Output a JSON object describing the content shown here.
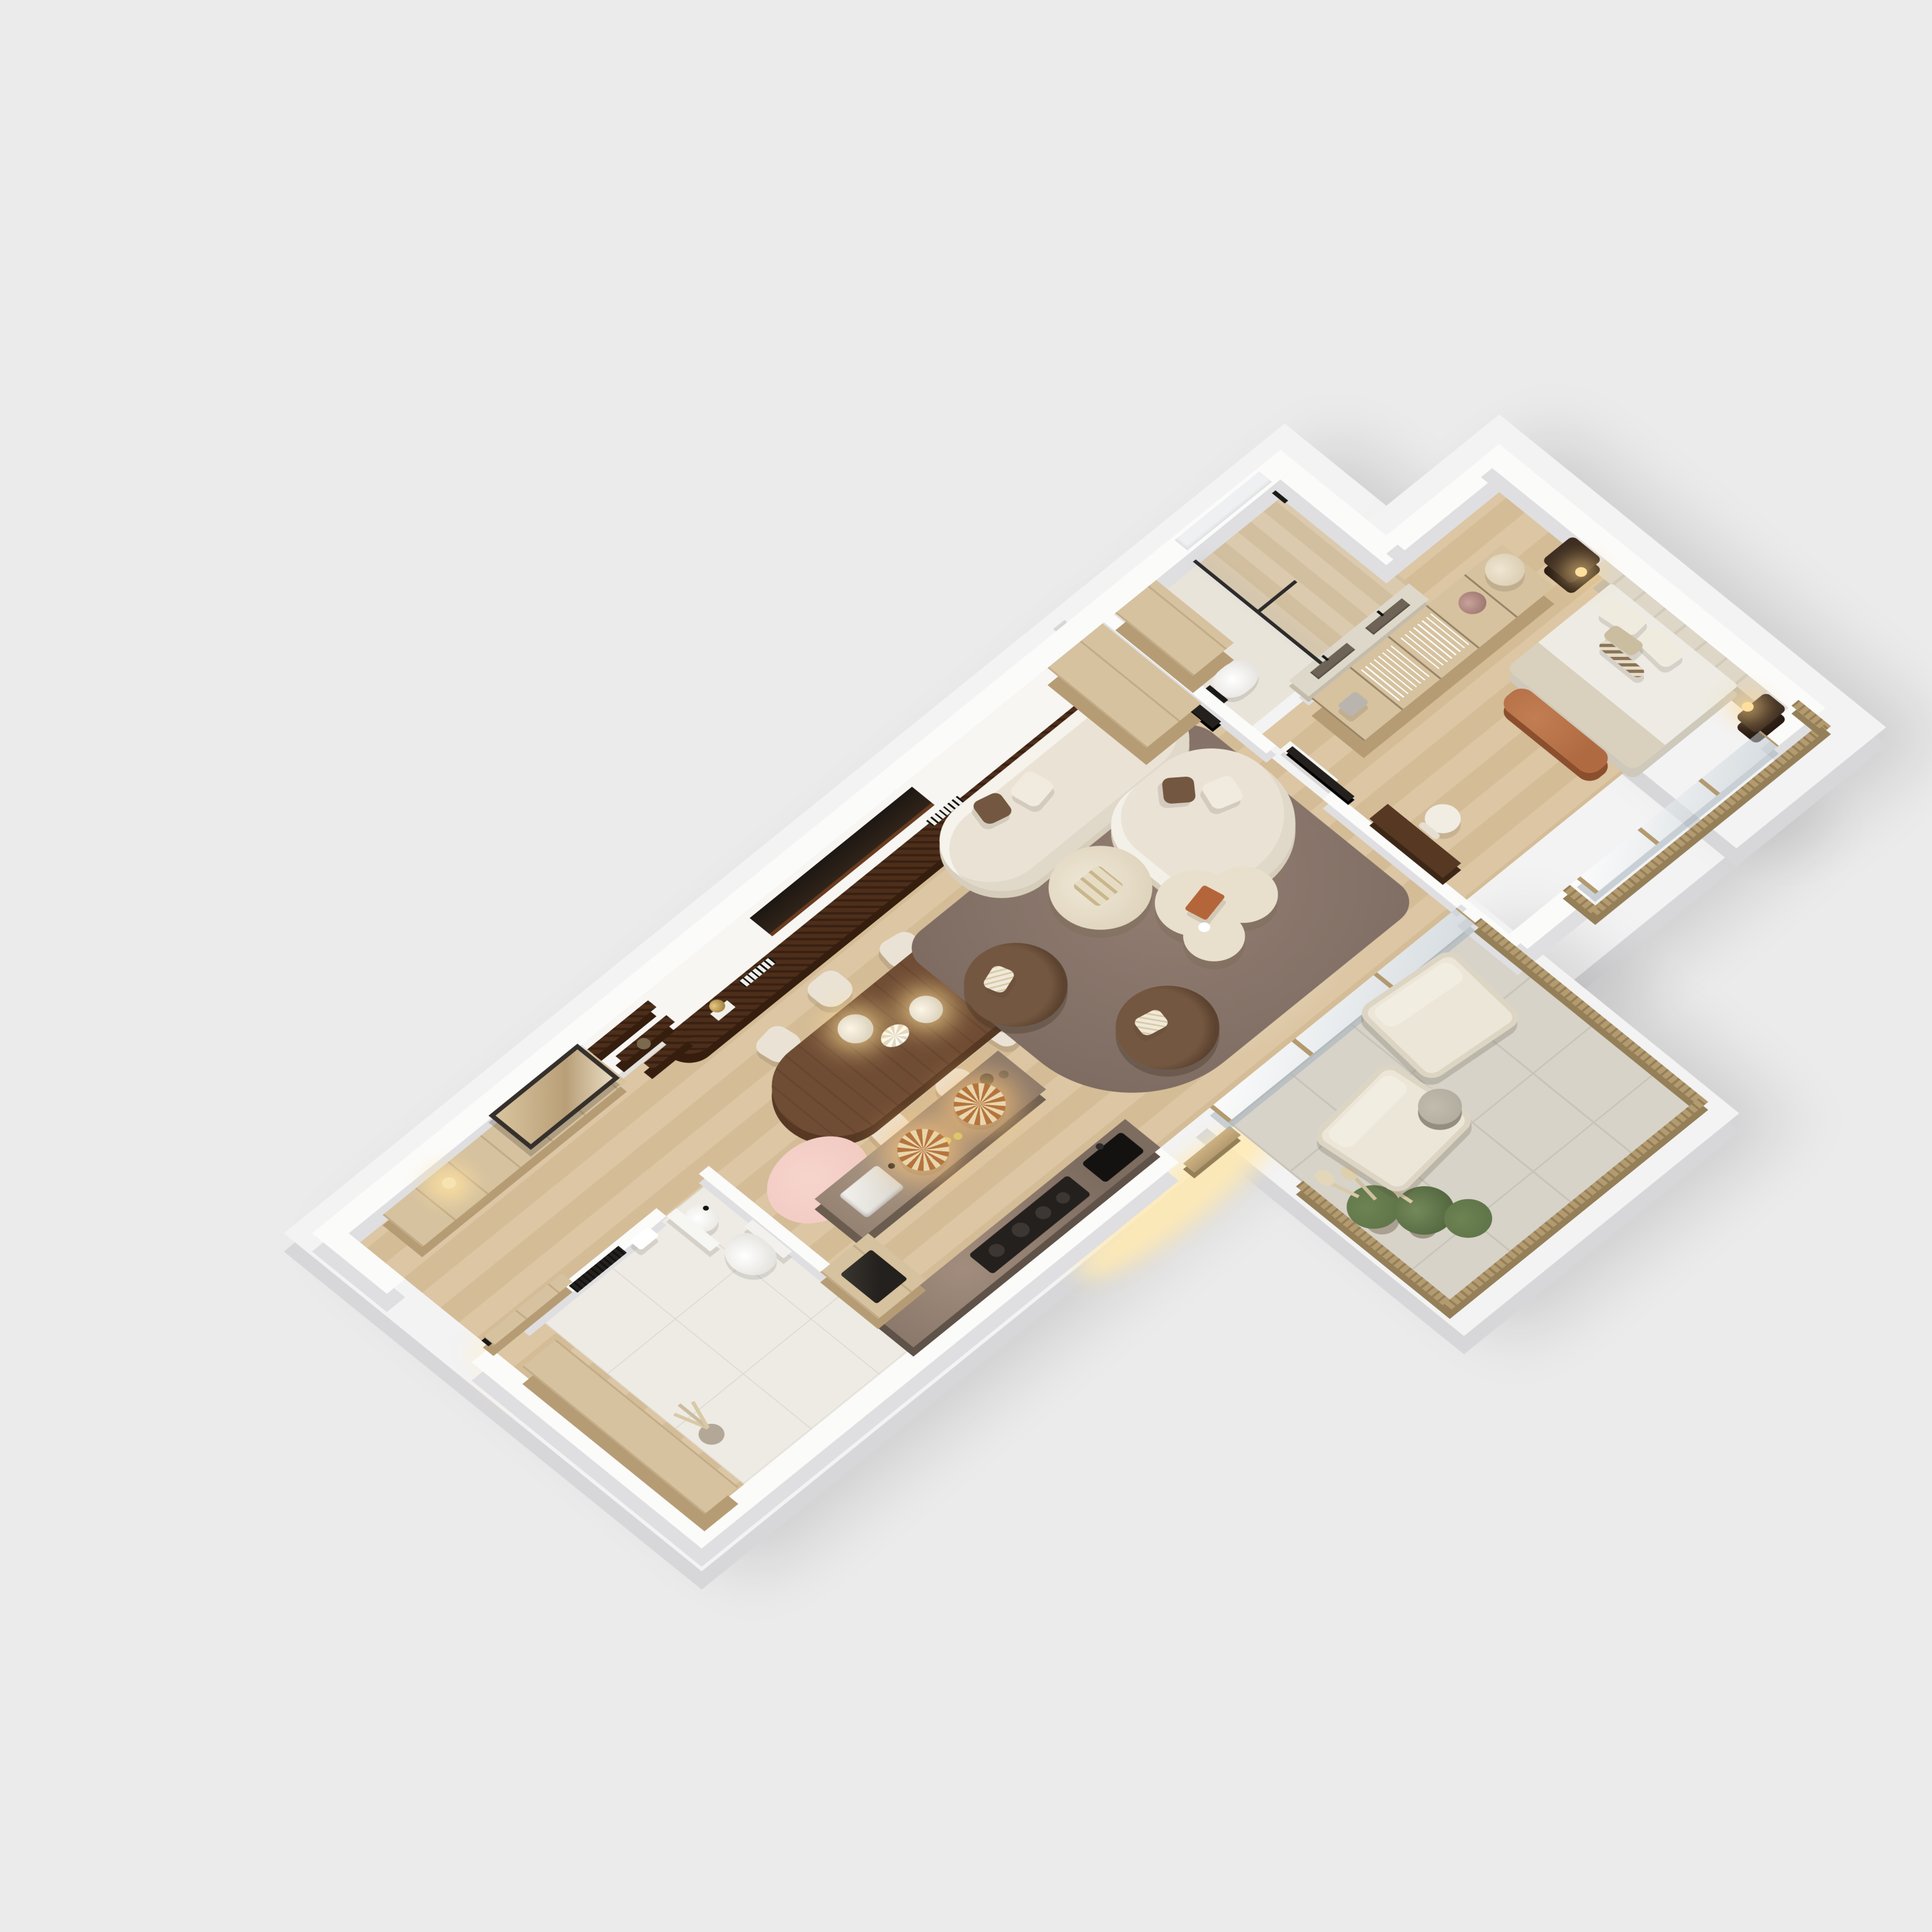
{
  "scene": {
    "type": "isometric-3d-floor-plan-render",
    "description": "Top-down axonometric cutaway render of a one-bedroom apartment with terrace",
    "visible_text": "none"
  },
  "palette": {
    "bg": "#ebebeb",
    "slab": "#f3f3f4",
    "slab-side": "#d7d7d9",
    "wall": "#fbfbfa",
    "wall-side": "#dfdfe1",
    "wood-a": "#dcc6a4",
    "wood-b": "#d4bc97",
    "oak": "#d6c29f",
    "oak-side": "#b69c74",
    "stone": "#e9e4da",
    "trav": "#dbcaae",
    "tile": "#edebe4",
    "tile-line": "#ddd9d0",
    "terr": "#d7d3c9",
    "terr-line": "#c8c4b9",
    "walnut": "#6f4c34",
    "walnut-d": "#563823",
    "burl": "#4e2e1a",
    "burl-d": "#361e0e",
    "cream": "#eae3d5",
    "cream-d": "#d6cdba",
    "brown": "#745740",
    "brown-d": "#5c4330",
    "rug": "#937e73",
    "rug-d": "#7e6c62",
    "brass": "#b39a6f",
    "brass-d": "#947f58",
    "dark": "#24201d",
    "marble": "#7d6c60",
    "marble-l": "#a28d7d",
    "pink": "#f2cbc3",
    "green": "#5f7549",
    "pampas": "#d9c9a8",
    "vanity-stone": "#ded8cb",
    "gray-stone": "#b3ada0",
    "rattan-a": "#b5743c",
    "rattan-b": "#e9d6ae",
    "glow": "#ffe3ae",
    "headboard": "#ded7c8",
    "linen": "#edebe3",
    "throw": "#d9d0bd",
    "rust": "#b06a42",
    "nightstand": "#3a2a1f"
  },
  "rooms": [
    {
      "name": "entry-hall",
      "floor": "oak-plank",
      "items": [
        "entry-door",
        "sideboard",
        "leaning-mirror",
        "wall-sconce",
        "pantry-cabinet"
      ]
    },
    {
      "name": "guest-bathroom",
      "floor": "large-tile",
      "items": [
        "toilet",
        "round-basin",
        "towel-radiator",
        "towel",
        "pampas-plant",
        "door",
        "pink-rug-outside"
      ]
    },
    {
      "name": "kitchen",
      "floor": "oak-plank",
      "items": [
        "dark-marble-counter",
        "induction-hob",
        "black-sink",
        "marble-island-with-sink",
        "oven-cabinet",
        "two-rattan-pendants",
        "exterior-door"
      ]
    },
    {
      "name": "dining-area",
      "floor": "oak-plank",
      "items": [
        "oval-walnut-table",
        "six-cream-chairs",
        "two-dome-pendants",
        "fluted-bowl"
      ]
    },
    {
      "name": "living-room",
      "floor": "oak-plank",
      "items": [
        "media-wall-with-fireplace",
        "burl-wood-plinth",
        "stepped-shelves",
        "sculpture",
        "corner-sofa-cream",
        "two-brown-swivel-armchairs",
        "round-travertine-coffee-table",
        "organic-travertine-coffee-table",
        "book",
        "taupe-rug",
        "tv",
        "wardrobe",
        "sliding-glass-doors-to-terrace"
      ]
    },
    {
      "name": "ensuite-bathroom",
      "floor": "stone",
      "items": [
        "walk-in-shower-travertine",
        "black-framed-glass",
        "wall-hung-toilet",
        "double-trough-vanity",
        "tall-oak-cabinet",
        "window-recess"
      ]
    },
    {
      "name": "bedroom",
      "floor": "oak-plank",
      "items": [
        "double-bed",
        "tall-channel-headboard",
        "two-dark-nightstands",
        "two-pendant-lights",
        "rust-bench",
        "open-closet-with-hangers",
        "storage-basket",
        "hat-box",
        "desk",
        "chair",
        "tv",
        "juliet-balcony-glass",
        "brass-railing"
      ]
    },
    {
      "name": "terrace",
      "floor": "terrazzo-tile",
      "items": [
        "two-cream-outdoor-armchairs",
        "stone-side-table",
        "planter-with-pampas-and-grasses",
        "brass-railing"
      ]
    }
  ]
}
